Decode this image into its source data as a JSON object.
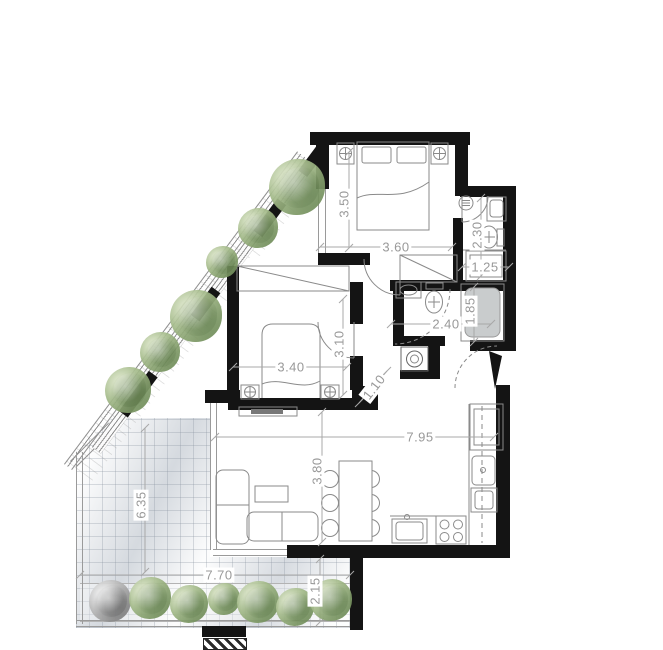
{
  "document": {
    "type": "apartment floor plan",
    "units": "m"
  },
  "colors": {
    "wall": "#141414",
    "dimension_text": "#999999",
    "furniture_line": "#8a8a8a",
    "foliage_green": "#809b67",
    "foliage_gray": "#9a9a9a",
    "terrace_tile": "#eef0f2",
    "bathtub_fill": "#c9cccd"
  },
  "dimensions": [
    {
      "id": "bedroom-top-depth",
      "label": "3.50",
      "x": 344,
      "y": 204,
      "rot": -90,
      "line": [
        349,
        152,
        349,
        248
      ]
    },
    {
      "id": "bedroom-top-width",
      "label": "3.60",
      "x": 396,
      "y": 247,
      "rot": 0,
      "line": [
        320,
        247,
        452,
        247
      ]
    },
    {
      "id": "bath-top-depth",
      "label": "2.30",
      "x": 477,
      "y": 235,
      "rot": -90,
      "line": [
        481,
        198,
        481,
        276
      ]
    },
    {
      "id": "bath-top-width",
      "label": "1.25",
      "x": 485,
      "y": 267,
      "rot": 0,
      "line": [
        462,
        267,
        509,
        267
      ]
    },
    {
      "id": "bath-mid-width",
      "label": "2.40",
      "x": 446,
      "y": 324,
      "rot": 0,
      "line": [
        391,
        324,
        491,
        324
      ]
    },
    {
      "id": "bathtub-length",
      "label": "1.85",
      "x": 470,
      "y": 311,
      "rot": -90,
      "line": [
        474,
        287,
        474,
        342
      ]
    },
    {
      "id": "bedroom-left-width",
      "label": "3.40",
      "x": 291,
      "y": 367,
      "rot": 0,
      "line": [
        233,
        367,
        347,
        367
      ]
    },
    {
      "id": "bedroom-left-depth",
      "label": "3.10",
      "x": 339,
      "y": 344,
      "rot": -90,
      "line": [
        343,
        299,
        343,
        395
      ]
    },
    {
      "id": "wall-segment",
      "label": "1.10",
      "x": 374,
      "y": 387,
      "rot": -52,
      "line": [
        359,
        403,
        387,
        371
      ]
    },
    {
      "id": "living-width",
      "label": "7.95",
      "x": 420,
      "y": 437,
      "rot": 0,
      "line": [
        215,
        437,
        494,
        437
      ]
    },
    {
      "id": "living-depth",
      "label": "3.80",
      "x": 317,
      "y": 471,
      "rot": -90,
      "line": [
        322,
        412,
        322,
        542
      ]
    },
    {
      "id": "terrace-depth",
      "label": "6.35",
      "x": 141,
      "y": 505,
      "rot": -90,
      "line": [
        145,
        428,
        145,
        572
      ]
    },
    {
      "id": "terrace-width",
      "label": "7.70",
      "x": 219,
      "y": 575,
      "rot": 0,
      "line": [
        80,
        575,
        350,
        575
      ]
    },
    {
      "id": "terrace-side",
      "label": "2.15",
      "x": 315,
      "y": 591,
      "rot": -90,
      "line": [
        320,
        559,
        320,
        622
      ]
    }
  ],
  "landscape": {
    "trees": [
      {
        "x": 297,
        "y": 187,
        "r": 28
      },
      {
        "x": 258,
        "y": 228,
        "r": 20
      },
      {
        "x": 222,
        "y": 262,
        "r": 16
      },
      {
        "x": 196,
        "y": 316,
        "r": 26
      },
      {
        "x": 160,
        "y": 352,
        "r": 20
      },
      {
        "x": 128,
        "y": 390,
        "r": 23
      }
    ],
    "bushes": [
      {
        "x": 110,
        "y": 601,
        "r": 21,
        "variant": "gray"
      },
      {
        "x": 150,
        "y": 598,
        "r": 21
      },
      {
        "x": 189,
        "y": 604,
        "r": 19
      },
      {
        "x": 224,
        "y": 599,
        "r": 16
      },
      {
        "x": 258,
        "y": 602,
        "r": 21
      },
      {
        "x": 295,
        "y": 607,
        "r": 19
      },
      {
        "x": 331,
        "y": 600,
        "r": 21
      }
    ]
  }
}
